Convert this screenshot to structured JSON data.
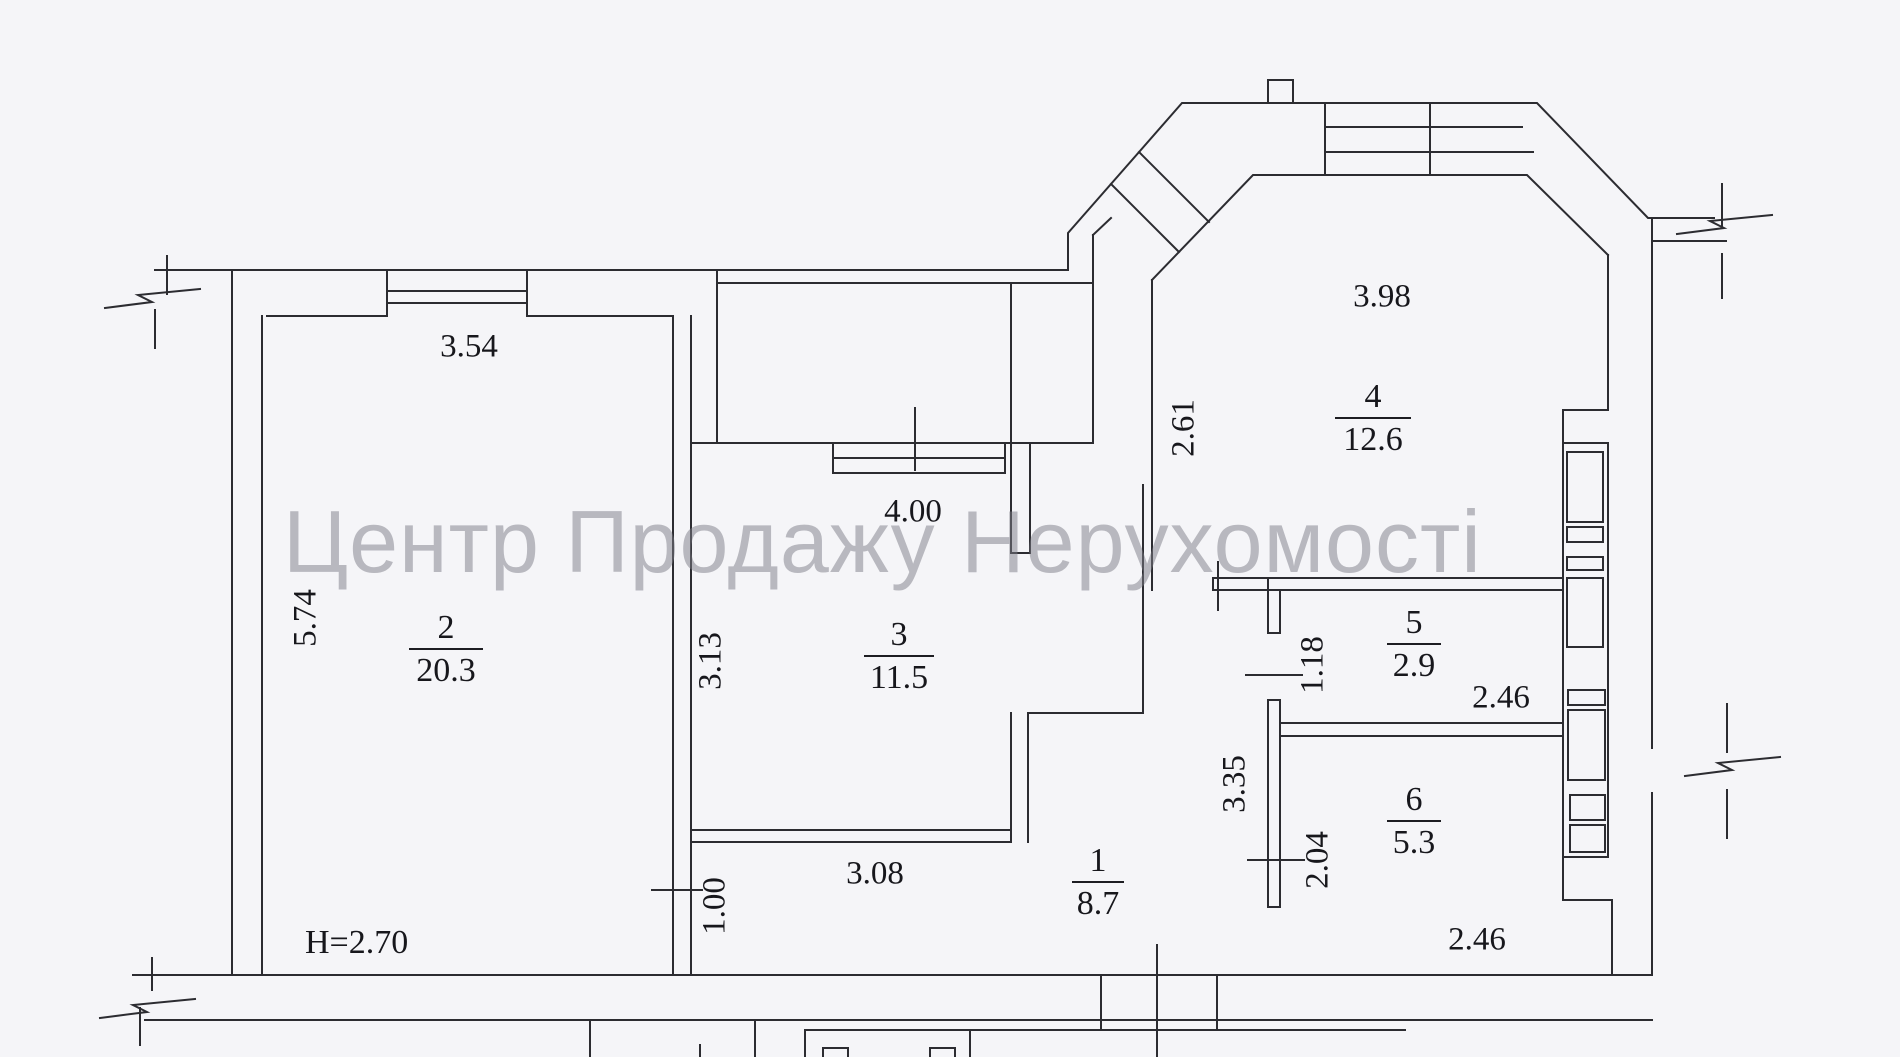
{
  "watermark": {
    "text": "Центр Продажу Нерухомості"
  },
  "plan": {
    "height_label": "H=2.70",
    "rooms": [
      {
        "id": "1",
        "number": "1",
        "area": "8.7"
      },
      {
        "id": "2",
        "number": "2",
        "area": "20.3"
      },
      {
        "id": "3",
        "number": "3",
        "area": "11.5"
      },
      {
        "id": "4",
        "number": "4",
        "area": "12.6"
      },
      {
        "id": "5",
        "number": "5",
        "area": "2.9"
      },
      {
        "id": "6",
        "number": "6",
        "area": "5.3"
      }
    ],
    "dims": [
      {
        "id": "top-wall-width",
        "text": "3.54"
      },
      {
        "id": "room2-depth",
        "text": "5.74"
      },
      {
        "id": "room3-width",
        "text": "4.00"
      },
      {
        "id": "room3-depth",
        "text": "3.13"
      },
      {
        "id": "hall-width",
        "text": "3.08"
      },
      {
        "id": "passage-width",
        "text": "1.00"
      },
      {
        "id": "room4-width",
        "text": "3.98"
      },
      {
        "id": "room4-depth",
        "text": "2.61"
      },
      {
        "id": "room5-depth",
        "text": "1.18"
      },
      {
        "id": "hall-depth",
        "text": "3.35"
      },
      {
        "id": "room6-depth",
        "text": "2.04"
      },
      {
        "id": "room5-width",
        "text": "2.46"
      },
      {
        "id": "room6-width",
        "text": "2.46"
      }
    ]
  }
}
